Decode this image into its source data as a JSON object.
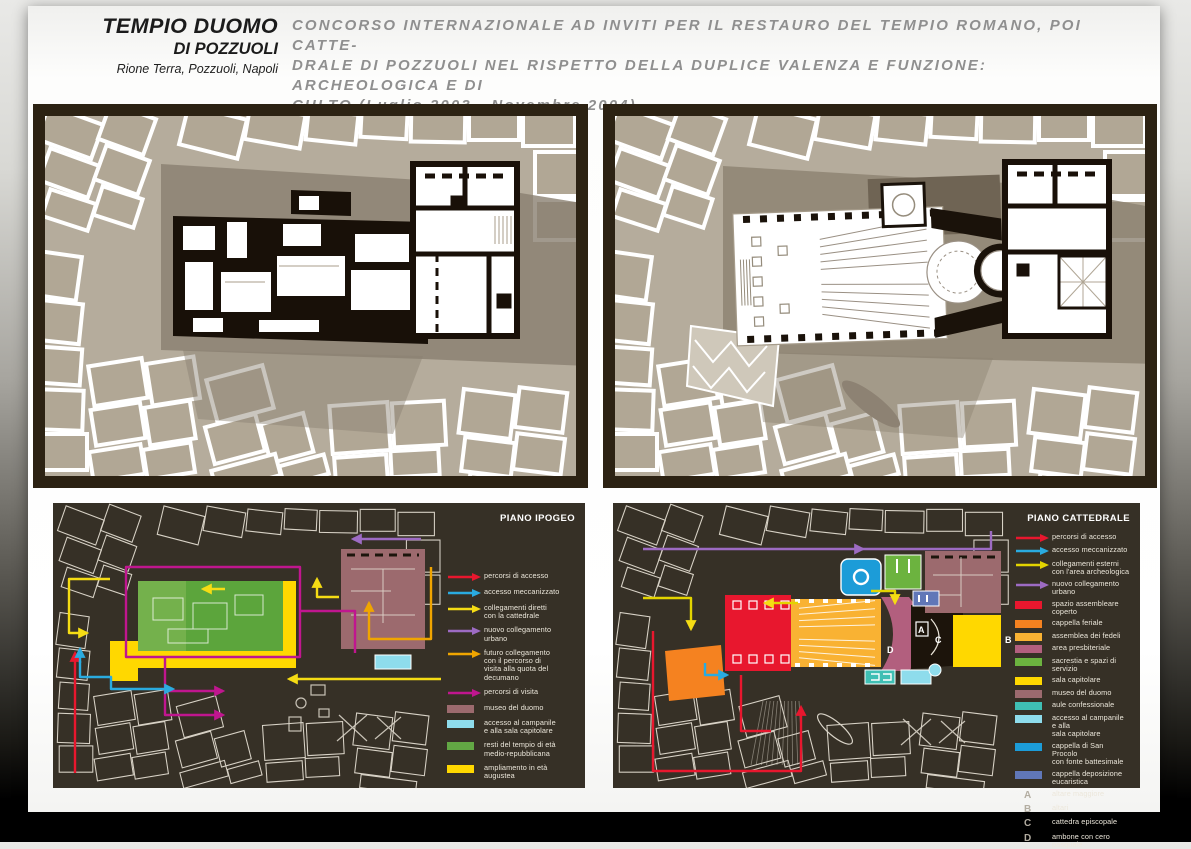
{
  "header": {
    "title_line1": "TEMPIO DUOMO",
    "title_line2": "DI POZZUOLI",
    "subtitle": "Rione Terra, Pozzuoli, Napoli",
    "description_lines": [
      "CONCORSO INTERNAZIONALE AD INVITI PER IL RESTAURO DEL TEMPIO ROMANO, POI CATTE-",
      "DRALE DI POZZUOLI NEL RISPETTO DELLA DUPLICE VALENZA E FUNZIONE: ARCHEOLOGICA E DI",
      "CULTO (Luglio 2003 - Novembre 2004)"
    ]
  },
  "colors": {
    "route_red": "#e8172e",
    "route_blue": "#2aabe0",
    "route_yellow": "#f5dc14",
    "route_violet": "#9d6bc3",
    "route_orange": "#f0a500",
    "route_magenta": "#c0168f",
    "area_green": "#5ca53c",
    "area_yellow": "#ffd800",
    "area_museo": "#9c6a6e",
    "area_lightblue": "#8edcec",
    "panel_dark_bg": "#363026",
    "panel_frame": "#2c2213",
    "city_beige": "#b5ac9c"
  },
  "panels": {
    "bottom_left": {
      "label": "PIANO IPOGEO",
      "legend": [
        {
          "type": "arrow",
          "color": "#e8172e",
          "label": "percorsi di accesso"
        },
        {
          "type": "arrow",
          "color": "#2aabe0",
          "label": "accesso meccanizzato"
        },
        {
          "type": "arrow",
          "color": "#f5dc14",
          "label": "collegamenti diretti\ncon la cattedrale"
        },
        {
          "type": "arrow",
          "color": "#9d6bc3",
          "label": "nuovo collegamento\nurbano"
        },
        {
          "type": "arrow",
          "color": "#f0a500",
          "label": "futuro collegamento\ncon il percorso di\nvisita alla quota del\ndecumano"
        },
        {
          "type": "arrow",
          "color": "#c0168f",
          "label": "percorsi di visita"
        },
        {
          "type": "swatch",
          "color": "#9c6a6e",
          "label": "museo del duomo"
        },
        {
          "type": "swatch",
          "color": "#8edcec",
          "label": "accesso al campanile\ne alla sala capitolare"
        },
        {
          "type": "swatch",
          "color": "#62a744",
          "label": "resti del tempio di età\nmedio-repubblicana"
        },
        {
          "type": "swatch",
          "color": "#ffd800",
          "label": "ampliamento in età\naugustea"
        }
      ]
    },
    "bottom_right": {
      "label": "PIANO CATTEDRALE",
      "legend": [
        {
          "type": "arrow",
          "color": "#e8172e",
          "label": "percorsi di accesso"
        },
        {
          "type": "arrow",
          "color": "#2aabe0",
          "label": "accesso meccanizzato"
        },
        {
          "type": "arrow",
          "color": "#e3d400",
          "label": "collegamenti esterni\ncon l'area archeologica"
        },
        {
          "type": "arrow",
          "color": "#9d6bc3",
          "label": "nuovo collegamento urbano"
        },
        {
          "type": "swatch",
          "color": "#e8172e",
          "label": "spazio assembleare coperto"
        },
        {
          "type": "swatch",
          "color": "#f58220",
          "label": "cappella feriale"
        },
        {
          "type": "swatch",
          "color": "#f9b233",
          "label": "assemblea dei fedeli"
        },
        {
          "type": "swatch",
          "color": "#b25f7e",
          "label": "area presbiteriale"
        },
        {
          "type": "swatch",
          "color": "#6cb33f",
          "label": "sacrestia e spazi di servizio"
        },
        {
          "type": "swatch",
          "color": "#ffd800",
          "label": "sala capitolare"
        },
        {
          "type": "swatch",
          "color": "#9c6a6e",
          "label": "museo del duomo"
        },
        {
          "type": "swatch",
          "color": "#3fbfb4",
          "label": "aule confessionale"
        },
        {
          "type": "swatch",
          "color": "#8edcec",
          "label": "accesso al campanile e alla\nsala capitolare"
        },
        {
          "type": "swatch",
          "color": "#1c9cd8",
          "label": "cappella di San Procolo\ncon fonte battesimale"
        },
        {
          "type": "swatch",
          "color": "#6077b8",
          "label": "cappella deposizione\neucaristica"
        },
        {
          "type": "letter",
          "key": "A",
          "label": "altare maggiore"
        },
        {
          "type": "letter",
          "key": "B",
          "label": "altari"
        },
        {
          "type": "letter",
          "key": "C",
          "label": "cattedra episcopale"
        },
        {
          "type": "letter",
          "key": "D",
          "label": "ambone con cero pasquale"
        }
      ],
      "plan_letters": [
        "A",
        "B",
        "C",
        "D"
      ]
    }
  }
}
